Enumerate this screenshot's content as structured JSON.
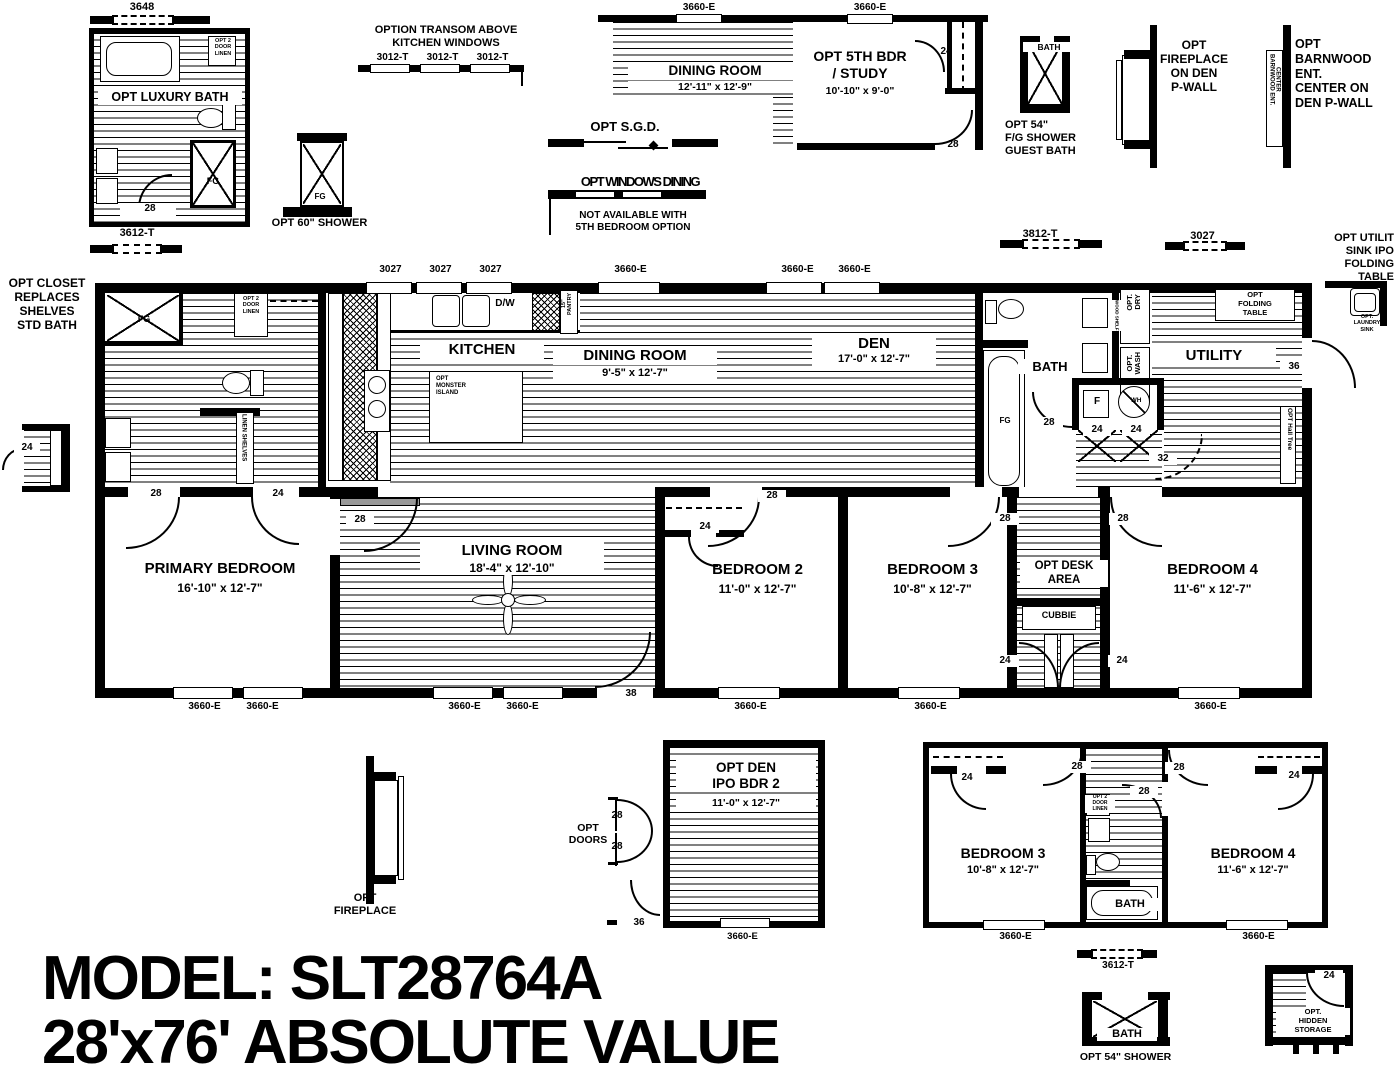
{
  "title": {
    "line1": "MODEL: SLT28764A",
    "line2": "28'x76' ABSOLUTE VALUE"
  },
  "colors": {
    "ink": "#000000",
    "paper": "#ffffff"
  },
  "annotations": [
    {
      "n": "dim-3648",
      "t": "3648",
      "x": 102,
      "y": 1,
      "w": 80,
      "s": 11
    },
    {
      "n": "opt-luxury-bath-label",
      "t": "OPT LUXURY BATH",
      "x": 98,
      "y": 90,
      "w": 140,
      "s": 12.5,
      "bg": 1
    },
    {
      "n": "fg-luxury-shower-label",
      "t": "FG",
      "x": 198,
      "y": 176,
      "w": 30,
      "s": 9
    },
    {
      "n": "luxury-linen-label",
      "t": "OPT 2\nDOOR\nLINEN",
      "x": 210,
      "y": 38,
      "w": 26,
      "s": 5.5
    },
    {
      "n": "door-28-luxury",
      "t": "28",
      "x": 136,
      "y": 203,
      "w": 24,
      "s": 10,
      "bg": 1
    },
    {
      "n": "dim-3612t-left",
      "t": "3612-T",
      "x": 97,
      "y": 227,
      "w": 80,
      "s": 11
    },
    {
      "n": "opt-60-shower-label",
      "t": "OPT 60\" SHOWER",
      "x": 262,
      "y": 217,
      "w": 115,
      "s": 11
    },
    {
      "n": "fg-60-shower-label",
      "t": "FG",
      "x": 305,
      "y": 192,
      "w": 30,
      "s": 8
    },
    {
      "n": "transom-title",
      "t": "OPTION TRANSOM ABOVE\nKITCHEN WINDOWS",
      "x": 356,
      "y": 24,
      "w": 180,
      "s": 11
    },
    {
      "n": "dim-3012t-1",
      "t": "3012-T",
      "x": 365,
      "y": 52,
      "w": 55,
      "s": 10
    },
    {
      "n": "dim-3012t-2",
      "t": "3012-T",
      "x": 415,
      "y": 52,
      "w": 55,
      "s": 10
    },
    {
      "n": "dim-3012t-3",
      "t": "3012-T",
      "x": 465,
      "y": 52,
      "w": 55,
      "s": 10
    },
    {
      "n": "dim-3660e-d1",
      "t": "3660-E",
      "x": 664,
      "y": 2,
      "w": 70,
      "s": 10
    },
    {
      "n": "dim-3660e-d2",
      "t": "3660-E",
      "x": 835,
      "y": 2,
      "w": 70,
      "s": 10
    },
    {
      "n": "dining-opt-label",
      "t": "DINING ROOM",
      "x": 628,
      "y": 63,
      "w": 170,
      "s": 13.5,
      "bg": 1
    },
    {
      "n": "dining-opt-dims",
      "t": "12'-11\" x  12'-9\"",
      "x": 628,
      "y": 81,
      "w": 170,
      "s": 10.5,
      "bg": 1
    },
    {
      "n": "bdr5-label",
      "t": "OPT 5TH BDR\n/ STUDY",
      "x": 790,
      "y": 48,
      "w": 140,
      "s": 14
    },
    {
      "n": "bdr5-dims",
      "t": "10'-10\" x  9'-0\"",
      "x": 790,
      "y": 85,
      "w": 140,
      "s": 10.5
    },
    {
      "n": "door-24-bdr5",
      "t": "24",
      "x": 934,
      "y": 46,
      "w": 24,
      "s": 10
    },
    {
      "n": "door-28-bdr5",
      "t": "28",
      "x": 941,
      "y": 139,
      "w": 24,
      "s": 10
    },
    {
      "n": "sgd-label",
      "t": "OPT S.G.D.",
      "x": 560,
      "y": 119,
      "w": 130,
      "s": 13
    },
    {
      "n": "windows-dining-label",
      "t": "OPT WINDOWS DINING",
      "x": 555,
      "y": 174,
      "w": 170,
      "s": 13,
      "sq": 1
    },
    {
      "n": "windows-dining-note",
      "t": "NOT AVAILABLE WITH\n5TH BEDROOM OPTION",
      "x": 553,
      "y": 210,
      "w": 160,
      "s": 10
    },
    {
      "n": "guest-bath-label",
      "t": "BATH",
      "x": 1023,
      "y": 42,
      "w": 48,
      "s": 8.5,
      "bg": 1
    },
    {
      "n": "guest-shower-label",
      "t": "OPT 54\"\nF/G SHOWER\nGUEST BATH",
      "x": 1005,
      "y": 119,
      "w": 82,
      "s": 11,
      "al": "l"
    },
    {
      "n": "fireplace-den-label",
      "t": "OPT\nFIREPLACE\nON DEN\nP-WALL",
      "x": 1148,
      "y": 38,
      "w": 92,
      "s": 12
    },
    {
      "n": "barnwood-vert-label",
      "t": "BARNWOOD ENT.\nCENTER",
      "x": 1268,
      "y": 54,
      "s": 6,
      "v": 1
    },
    {
      "n": "barnwood-label",
      "t": "OPT\nBARNWOOD\nENT.\nCENTER ON\nDEN P-WALL",
      "x": 1295,
      "y": 37,
      "w": 100,
      "s": 12.5,
      "al": "l"
    },
    {
      "n": "dim-3812t",
      "t": "3812-T",
      "x": 1000,
      "y": 228,
      "w": 80,
      "s": 11
    },
    {
      "n": "dim-3027-float",
      "t": "3027",
      "x": 1165,
      "y": 230,
      "w": 75,
      "s": 11
    },
    {
      "n": "utility-sink-title",
      "t": "OPT UTILIT\nSINK IPO\nFOLDING\nTABLE",
      "x": 1308,
      "y": 232,
      "w": 86,
      "s": 11,
      "al": "r"
    },
    {
      "n": "laundry-sink-label",
      "t": "OPT.\nLAUNDRY\nSINK",
      "x": 1342,
      "y": 314,
      "w": 50,
      "s": 5.5
    },
    {
      "n": "opt-closet-title",
      "t": "OPT  CLOSET\nREPLACES\nSHELVES\nSTD BATH",
      "x": 2,
      "y": 276,
      "w": 90,
      "s": 12
    },
    {
      "n": "door-24-closet-detail",
      "t": "24",
      "x": 14,
      "y": 442,
      "w": 22,
      "s": 10,
      "bg": 1
    },
    {
      "n": "dim-3027-k1",
      "t": "3027",
      "x": 368,
      "y": 264,
      "w": 45,
      "s": 10
    },
    {
      "n": "dim-3027-k2",
      "t": "3027",
      "x": 418,
      "y": 264,
      "w": 45,
      "s": 10
    },
    {
      "n": "dim-3027-k3",
      "t": "3027",
      "x": 468,
      "y": 264,
      "w": 45,
      "s": 10
    },
    {
      "n": "dim-3660e-dining",
      "t": "3660-E",
      "x": 598,
      "y": 264,
      "w": 65,
      "s": 10
    },
    {
      "n": "dim-3660e-den1",
      "t": "3660-E",
      "x": 765,
      "y": 264,
      "w": 65,
      "s": 10
    },
    {
      "n": "dim-3660e-den2",
      "t": "3660-E",
      "x": 822,
      "y": 264,
      "w": 65,
      "s": 10
    },
    {
      "n": "fg-primary-shower-label",
      "t": "FG",
      "x": 130,
      "y": 314,
      "w": 28,
      "s": 9
    },
    {
      "n": "primary-linen-label",
      "t": "OPT 2\nDOOR\nLINEN",
      "x": 235,
      "y": 296,
      "w": 32,
      "s": 5.5
    },
    {
      "n": "linen-shelves-vert",
      "t": "LINEN SHELVES",
      "x": 238,
      "y": 414,
      "s": 6,
      "v": 1,
      "bg": 1
    },
    {
      "n": "door-28-pbath",
      "t": "28",
      "x": 142,
      "y": 488,
      "w": 24,
      "s": 10,
      "bg": 1
    },
    {
      "n": "door-24-pbath",
      "t": "24",
      "x": 264,
      "y": 488,
      "w": 24,
      "s": 10,
      "bg": 1
    },
    {
      "n": "kitchen-label",
      "t": "KITCHEN",
      "x": 420,
      "y": 341,
      "w": 120,
      "s": 15,
      "bg": 1
    },
    {
      "n": "dining-label",
      "t": "DINING ROOM",
      "x": 553,
      "y": 347,
      "w": 160,
      "s": 15,
      "bg": 1
    },
    {
      "n": "dining-dims",
      "t": "9'-5\" x  12'-7\"",
      "x": 553,
      "y": 367,
      "w": 160,
      "s": 11,
      "bg": 1
    },
    {
      "n": "island-label",
      "t": "OPT\nMONSTER\nISLAND",
      "x": 436,
      "y": 376,
      "w": 54,
      "s": 6,
      "al": "l"
    },
    {
      "n": "dw-label",
      "t": "D/W",
      "x": 487,
      "y": 298,
      "w": 36,
      "s": 10
    },
    {
      "n": "pantry-vert-label",
      "t": "15\"\nPANTRY",
      "x": 562,
      "y": 293,
      "s": 5.5,
      "vu": 1
    },
    {
      "n": "den-label",
      "t": "DEN",
      "x": 812,
      "y": 335,
      "w": 120,
      "s": 15,
      "bg": 1
    },
    {
      "n": "den-dims",
      "t": "17'-0\" x  12'-7\"",
      "x": 812,
      "y": 353,
      "w": 120,
      "s": 11,
      "bg": 1
    },
    {
      "n": "bath-label",
      "t": "BATH",
      "x": 1018,
      "y": 359,
      "w": 60,
      "s": 13,
      "bg": 1
    },
    {
      "n": "fg-bath-tub-label",
      "t": "FG",
      "x": 992,
      "y": 416,
      "w": 26,
      "s": 8
    },
    {
      "n": "door-28-bath",
      "t": "28",
      "x": 1035,
      "y": 417,
      "w": 24,
      "s": 10,
      "bg": 1
    },
    {
      "n": "furnace-label",
      "t": "F",
      "x": 1085,
      "y": 396,
      "w": 24,
      "s": 10
    },
    {
      "n": "wh-label",
      "t": "WH",
      "x": 1124,
      "y": 397,
      "w": 24,
      "s": 6.5
    },
    {
      "n": "door-24-util-1",
      "t": "24",
      "x": 1083,
      "y": 424,
      "w": 24,
      "s": 10,
      "bg": 1
    },
    {
      "n": "door-24-util-2",
      "t": "24",
      "x": 1122,
      "y": 424,
      "w": 24,
      "s": 10,
      "bg": 1
    },
    {
      "n": "door-32",
      "t": "32",
      "x": 1149,
      "y": 453,
      "w": 24,
      "s": 10,
      "bg": 1
    },
    {
      "n": "optdry-vert",
      "t": "OPT.\nDRY",
      "x": 1126,
      "y": 294,
      "s": 7.5,
      "vu": 1
    },
    {
      "n": "optwash-vert",
      "t": "OPT.\nWASH",
      "x": 1126,
      "y": 352,
      "s": 7.5,
      "vu": 1
    },
    {
      "n": "wood-shelf-vert",
      "t": "WOOD SHELF",
      "x": 1112,
      "y": 300,
      "s": 4.5,
      "v": 1,
      "bg": 1
    },
    {
      "n": "folding-table-label",
      "t": "OPT\nFOLDING\nTABLE",
      "x": 1217,
      "y": 291,
      "w": 76,
      "s": 7.5
    },
    {
      "n": "utility-label",
      "t": "UTILITY",
      "x": 1152,
      "y": 347,
      "w": 120,
      "s": 15,
      "bg": 1
    },
    {
      "n": "door-36-utility",
      "t": "36",
      "x": 1280,
      "y": 361,
      "w": 24,
      "s": 10,
      "bg": 1
    },
    {
      "n": "hall-tree-vert",
      "t": "OPT Hall Tree",
      "x": 1283,
      "y": 408,
      "s": 6.5,
      "v": 1,
      "bg": 1
    },
    {
      "n": "door-28-living-entry",
      "t": "28",
      "x": 346,
      "y": 514,
      "w": 24,
      "s": 10,
      "bg": 1
    },
    {
      "n": "primary-bedroom-label",
      "t": "PRIMARY BEDROOM",
      "x": 125,
      "y": 560,
      "w": 190,
      "s": 15
    },
    {
      "n": "primary-bedroom-dims",
      "t": "16'-10\" x  12'-7\"",
      "x": 125,
      "y": 581,
      "w": 190,
      "s": 12
    },
    {
      "n": "living-room-label",
      "t": "LIVING ROOM",
      "x": 420,
      "y": 542,
      "w": 180,
      "s": 15,
      "bg": 1
    },
    {
      "n": "living-room-dims",
      "t": "18'-4\" x  12'-10\"",
      "x": 420,
      "y": 561,
      "w": 180,
      "s": 12,
      "bg": 1
    },
    {
      "n": "bedroom2-label",
      "t": "BEDROOM 2",
      "x": 680,
      "y": 561,
      "w": 155,
      "s": 15
    },
    {
      "n": "bedroom2-dims",
      "t": "11'-0\" x  12'-7\"",
      "x": 680,
      "y": 582,
      "w": 155,
      "s": 12
    },
    {
      "n": "bedroom3-label",
      "t": "BEDROOM 3",
      "x": 855,
      "y": 561,
      "w": 155,
      "s": 15
    },
    {
      "n": "bedroom3-dims",
      "t": "10'-8\" x  12'-7\"",
      "x": 855,
      "y": 582,
      "w": 155,
      "s": 12
    },
    {
      "n": "desk-area-label",
      "t": "OPT DESK\nAREA",
      "x": 1020,
      "y": 560,
      "w": 84,
      "s": 11.5,
      "bg": 1
    },
    {
      "n": "cubbie-label",
      "t": "CUBBIE",
      "x": 1024,
      "y": 610,
      "w": 70,
      "s": 9
    },
    {
      "n": "bedroom4-label",
      "t": "BEDROOM 4",
      "x": 1135,
      "y": 561,
      "w": 155,
      "s": 15
    },
    {
      "n": "bedroom4-dims",
      "t": "11'-6\" x  12'-7\"",
      "x": 1135,
      "y": 582,
      "w": 155,
      "s": 12
    },
    {
      "n": "door-28-bed2",
      "t": "28",
      "x": 758,
      "y": 490,
      "w": 24,
      "s": 10,
      "bg": 1
    },
    {
      "n": "closet-24-bed2",
      "t": "24",
      "x": 691,
      "y": 521,
      "w": 24,
      "s": 10,
      "bg": 1
    },
    {
      "n": "door-28-bed3",
      "t": "28",
      "x": 991,
      "y": 513,
      "w": 24,
      "s": 10,
      "bg": 1
    },
    {
      "n": "door-28-bed4",
      "t": "28",
      "x": 1109,
      "y": 513,
      "w": 24,
      "s": 10,
      "bg": 1
    },
    {
      "n": "door-24-cubbie-l",
      "t": "24",
      "x": 991,
      "y": 655,
      "w": 24,
      "s": 10,
      "bg": 1
    },
    {
      "n": "door-24-cubbie-r",
      "t": "24",
      "x": 1108,
      "y": 655,
      "w": 24,
      "s": 10,
      "bg": 1
    },
    {
      "n": "door-38-living",
      "t": "38",
      "x": 617,
      "y": 688,
      "w": 24,
      "s": 10,
      "bg": 1
    },
    {
      "n": "win-3660e-pb1",
      "t": "3660-E",
      "x": 172,
      "y": 701,
      "w": 65,
      "s": 10
    },
    {
      "n": "win-3660e-pb2",
      "t": "3660-E",
      "x": 230,
      "y": 701,
      "w": 65,
      "s": 10
    },
    {
      "n": "win-3660e-lr1",
      "t": "3660-E",
      "x": 432,
      "y": 701,
      "w": 65,
      "s": 10
    },
    {
      "n": "win-3660e-lr2",
      "t": "3660-E",
      "x": 490,
      "y": 701,
      "w": 65,
      "s": 10
    },
    {
      "n": "win-3660e-b2",
      "t": "3660-E",
      "x": 718,
      "y": 701,
      "w": 65,
      "s": 10
    },
    {
      "n": "win-3660e-b3",
      "t": "3660-E",
      "x": 898,
      "y": 701,
      "w": 65,
      "s": 10
    },
    {
      "n": "win-3660e-b4",
      "t": "3660-E",
      "x": 1178,
      "y": 701,
      "w": 65,
      "s": 10
    },
    {
      "n": "opt-fireplace-label",
      "t": "OPT\nFIREPLACE",
      "x": 315,
      "y": 892,
      "w": 100,
      "s": 11
    },
    {
      "n": "opt-den-label",
      "t": "OPT  DEN\nIPO BDR 2",
      "x": 676,
      "y": 760,
      "w": 136,
      "s": 13.5,
      "bg": 1
    },
    {
      "n": "opt-den-dims",
      "t": "11'-0\" x  12'-7\"",
      "x": 676,
      "y": 797,
      "w": 136,
      "s": 10.5,
      "bg": 1
    },
    {
      "n": "opt-doors-label",
      "t": "OPT\nDOORS",
      "x": 560,
      "y": 822,
      "w": 56,
      "s": 10.5
    },
    {
      "n": "door-28-optden-1",
      "t": "28",
      "x": 605,
      "y": 810,
      "w": 24,
      "s": 10
    },
    {
      "n": "door-28-optden-2",
      "t": "28",
      "x": 605,
      "y": 841,
      "w": 24,
      "s": 10
    },
    {
      "n": "door-36-optden",
      "t": "36",
      "x": 627,
      "y": 917,
      "w": 24,
      "s": 10
    },
    {
      "n": "win-3660e-optden",
      "t": "3660-E",
      "x": 710,
      "y": 931,
      "w": 65,
      "s": 9.5
    },
    {
      "n": "alt-bed3-label",
      "t": "BEDROOM 3",
      "x": 923,
      "y": 845,
      "w": 160,
      "s": 14
    },
    {
      "n": "alt-bed3-dims",
      "t": "10'-8\" x  12'-7\"",
      "x": 923,
      "y": 864,
      "w": 160,
      "s": 11
    },
    {
      "n": "alt-bed4-label",
      "t": "BEDROOM 4",
      "x": 1173,
      "y": 845,
      "w": 160,
      "s": 14
    },
    {
      "n": "alt-bed4-dims",
      "t": "11'-6\" x  12'-7\"",
      "x": 1173,
      "y": 864,
      "w": 160,
      "s": 11
    },
    {
      "n": "alt-bath-label",
      "t": "BATH",
      "x": 1100,
      "y": 898,
      "w": 56,
      "s": 11,
      "bg": 1
    },
    {
      "n": "alt-closet24-l",
      "t": "24",
      "x": 955,
      "y": 772,
      "w": 24,
      "s": 10
    },
    {
      "n": "alt-closet24-r",
      "t": "24",
      "x": 1282,
      "y": 770,
      "w": 24,
      "s": 10
    },
    {
      "n": "alt-door28-l",
      "t": "28",
      "x": 1063,
      "y": 761,
      "w": 24,
      "s": 10,
      "bg": 1
    },
    {
      "n": "alt-door28-r",
      "t": "28",
      "x": 1165,
      "y": 762,
      "w": 24,
      "s": 10,
      "bg": 1
    },
    {
      "n": "alt-door28-bath",
      "t": "28",
      "x": 1130,
      "y": 786,
      "w": 24,
      "s": 10,
      "bg": 1
    },
    {
      "n": "alt-linen-label",
      "t": "OPT 2\nDOOR\nLINEN",
      "x": 1085,
      "y": 795,
      "w": 26,
      "s": 5,
      "bg": 1
    },
    {
      "n": "alt-win-3660e-l",
      "t": "3660-E",
      "x": 983,
      "y": 931,
      "w": 65,
      "s": 10
    },
    {
      "n": "alt-win-3660e-r",
      "t": "3660-E",
      "x": 1226,
      "y": 931,
      "w": 65,
      "s": 10
    },
    {
      "n": "dim-3612t-bottom",
      "t": "3612-T",
      "x": 1078,
      "y": 960,
      "w": 80,
      "s": 10
    },
    {
      "n": "shower54-bath-label",
      "t": "BATH",
      "x": 1097,
      "y": 1028,
      "w": 56,
      "s": 11,
      "bg": 1
    },
    {
      "n": "opt-54-shower-label",
      "t": "OPT 54\" SHOWER",
      "x": 1068,
      "y": 1051,
      "w": 115,
      "s": 10.5
    },
    {
      "n": "hidden-storage-label",
      "t": "OPT.\nHIDDEN\nSTORAGE",
      "x": 1276,
      "y": 1008,
      "w": 70,
      "s": 7.5,
      "bg": 1
    },
    {
      "n": "door-24-hidden",
      "t": "24",
      "x": 1315,
      "y": 970,
      "w": 24,
      "s": 10,
      "bg": 1
    }
  ]
}
